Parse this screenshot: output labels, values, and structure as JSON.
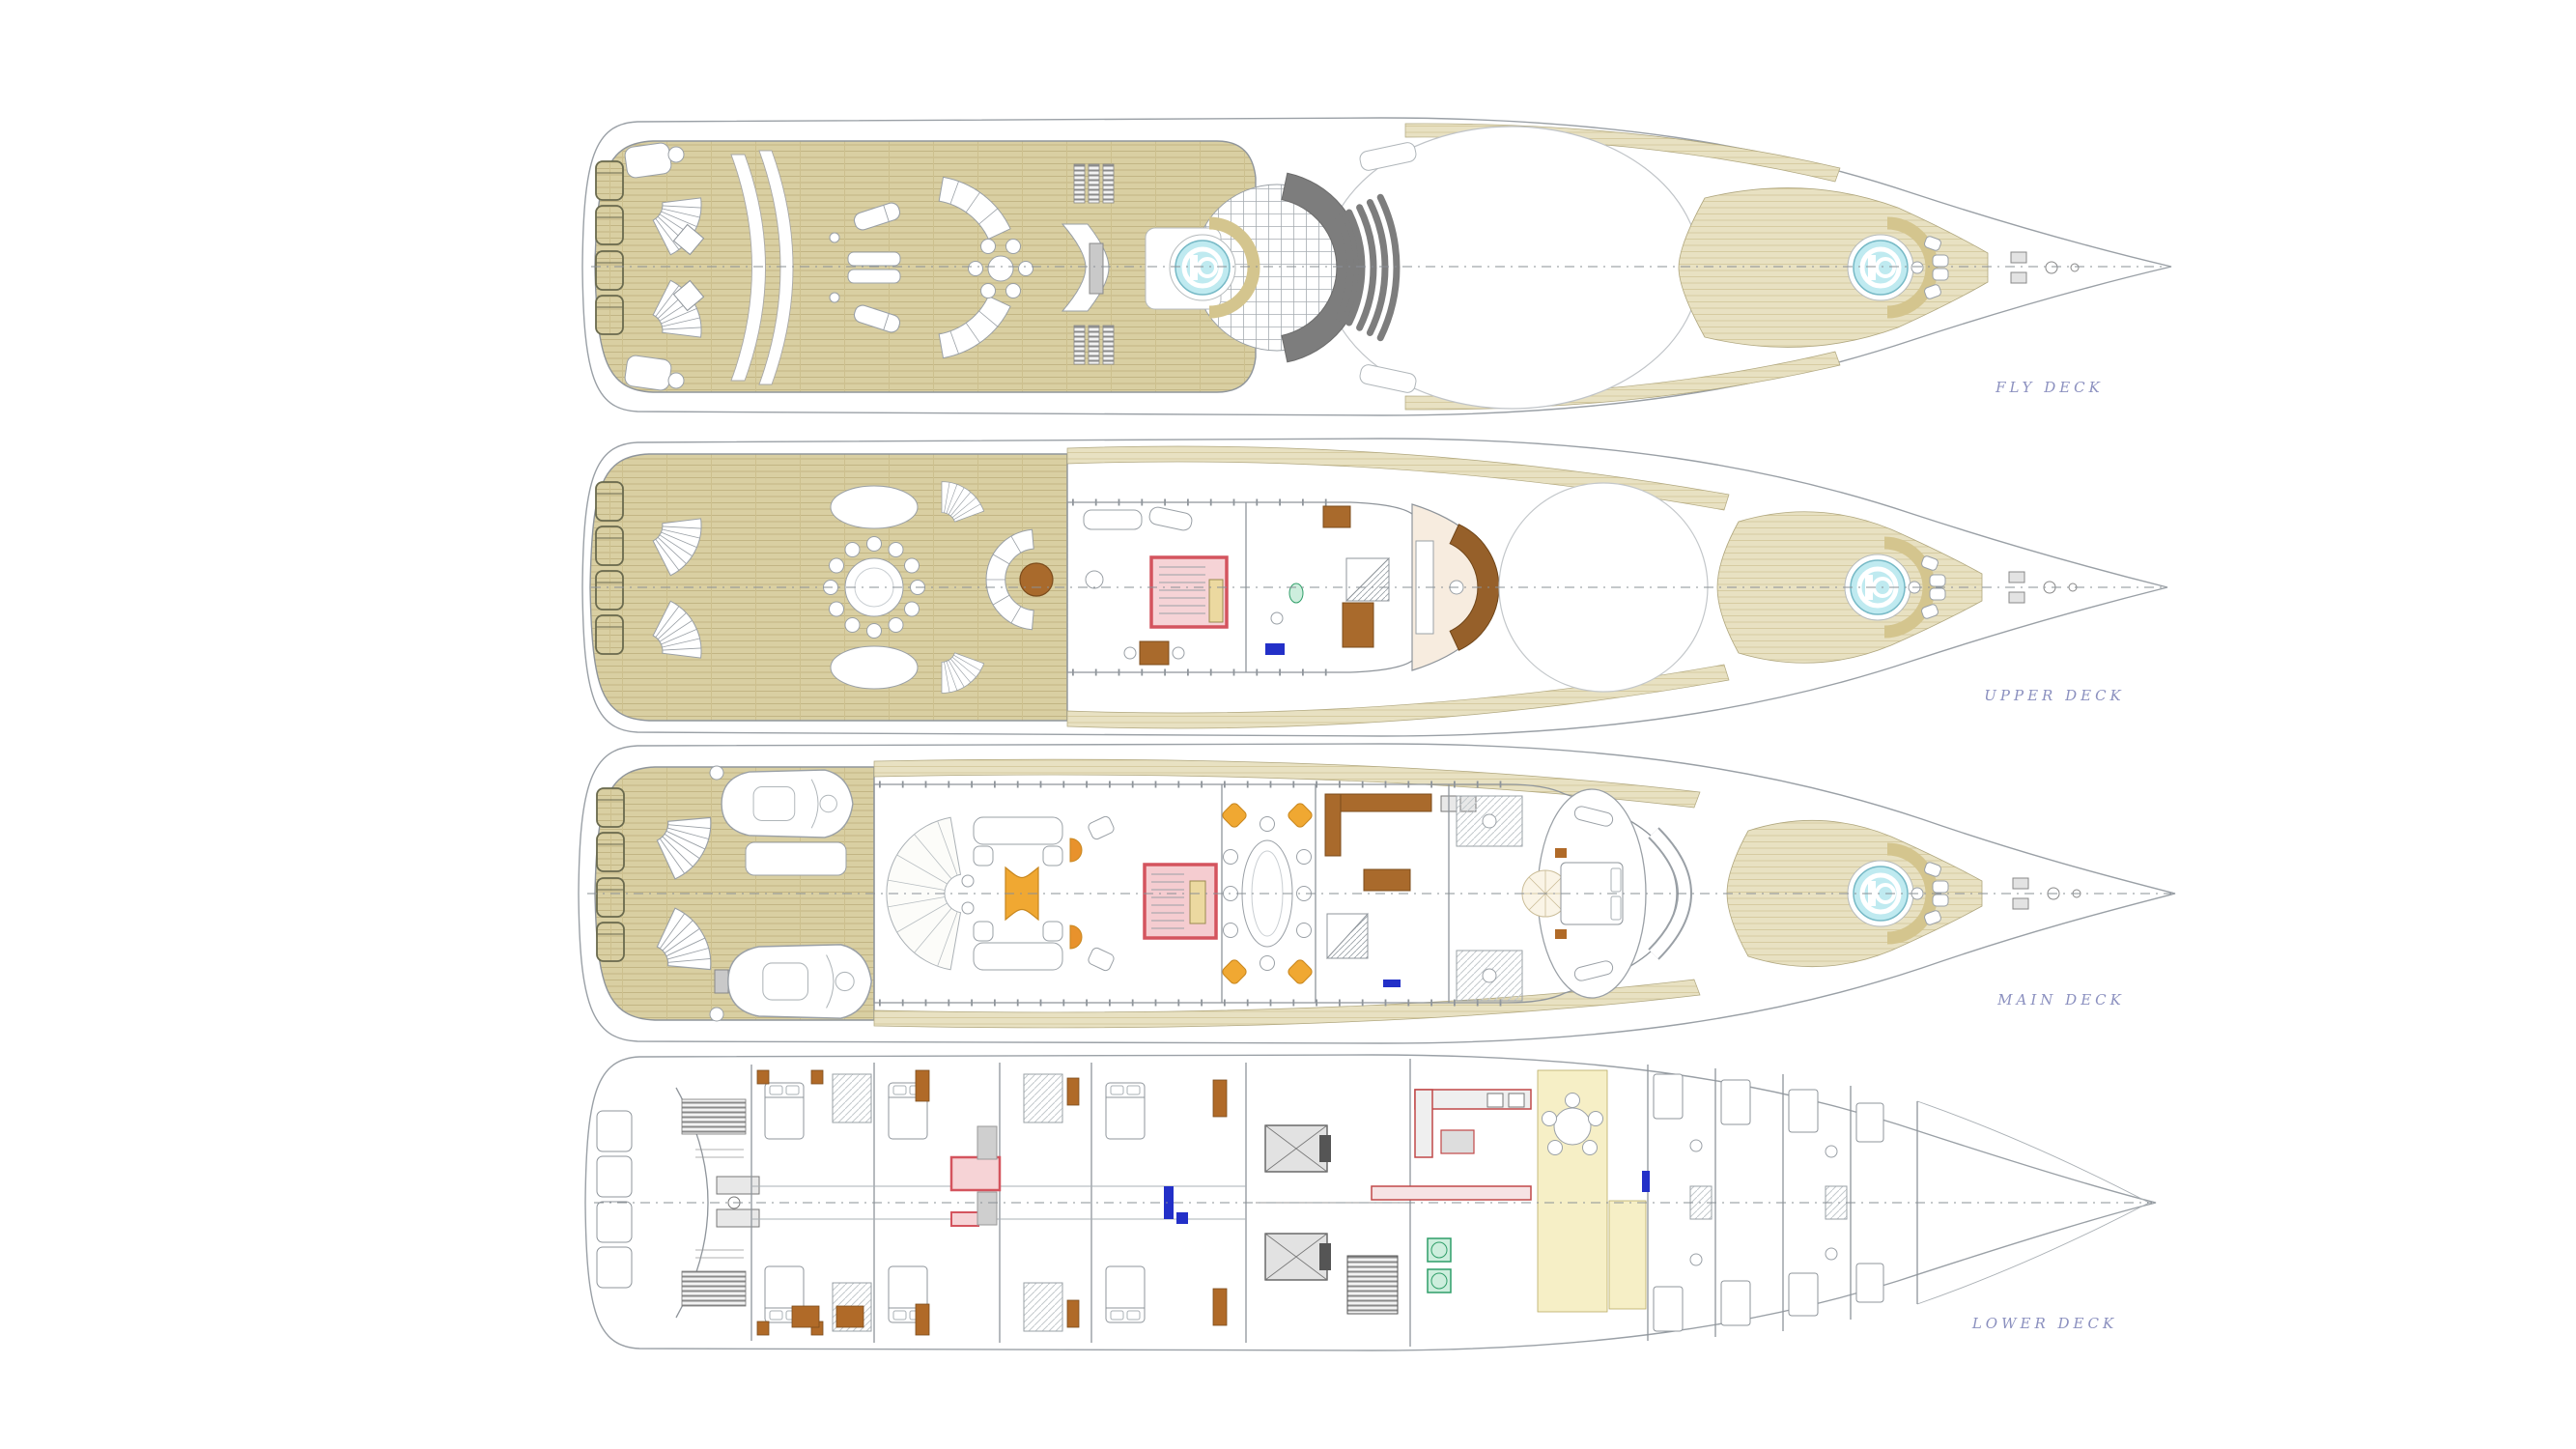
{
  "document": {
    "type": "yacht-general-arrangement-plan",
    "background": "#ffffff",
    "orientation": "bow-right"
  },
  "decks": [
    {
      "id": "fly-deck",
      "label": "FLY DECK",
      "features": [
        "stern-sun-pads",
        "twin-curved-stairs",
        "sun-loungers",
        "curved-sofas",
        "alfresco-dining-set",
        "wet-bar",
        "amidships-spa-pool",
        "skylight-grid",
        "mast-arch",
        "funnel-vents",
        "open-sun-deck-roof",
        "foredeck-spa-pool",
        "bow-seating",
        "anchor-windlass"
      ]
    },
    {
      "id": "upper-deck",
      "label": "UPPER DECK",
      "features": [
        "stern-sun-pads",
        "twin-curved-stairs",
        "round-alfresco-dining-table",
        "dining-chairs",
        "lounge-settee-ring",
        "cocktail-table",
        "sky-lounge",
        "sofas",
        "stairwell",
        "elevator",
        "games-table",
        "day-head",
        "pantry",
        "wheelhouse",
        "helm-console",
        "saloon-skylight",
        "foredeck-spa-pool",
        "bow-seating",
        "anchor-windlass"
      ]
    },
    {
      "id": "main-deck",
      "label": "MAIN DECK",
      "features": [
        "stern-sun-pads",
        "twin-curved-stairs",
        "tenders",
        "sun-bed",
        "aft-deck",
        "saloon-entrance-fan",
        "main-saloon",
        "sofas",
        "grand-piano",
        "armchairs",
        "stairwell",
        "elevator",
        "formal-dining-table",
        "dining-chairs",
        "galley",
        "day-head",
        "his-hers-bathrooms",
        "master-suite",
        "master-bed",
        "round-carpet",
        "observation-seating",
        "foredeck-spa-pool",
        "anchor-windlass"
      ]
    },
    {
      "id": "lower-deck",
      "label": "LOWER DECK",
      "features": [
        "swim-platform-steps",
        "transom-garage",
        "stern-machinery",
        "guest-cabins",
        "guest-beds",
        "en-suite-bathrooms",
        "dressing-tables",
        "stairwell",
        "elevator",
        "engine-room",
        "generators",
        "galley",
        "laundry-machines",
        "crew-mess",
        "crew-cabins",
        "forepeak"
      ]
    }
  ],
  "colors": {
    "teak": "#d9cfa2",
    "teak_light": "#e8e1c2",
    "hull_outline": "#9aa0a6",
    "pool_water": "#bfeaf0",
    "pool_rim": "#76b9c6",
    "stairwell_red": "#d4545e",
    "stairwell_fill": "#f6d3d6",
    "elevator_tan": "#ecd9a0",
    "furniture_yellow": "#f0a832",
    "wood_brown": "#a96a2c",
    "console_brown": "#96602a",
    "mast_gray": "#7d7d7d",
    "accent_blue": "#2330c8",
    "laundry_green": "#2f9e68",
    "crew_area_yellow": "#f6efc6",
    "label_text": "#8b90bf"
  }
}
